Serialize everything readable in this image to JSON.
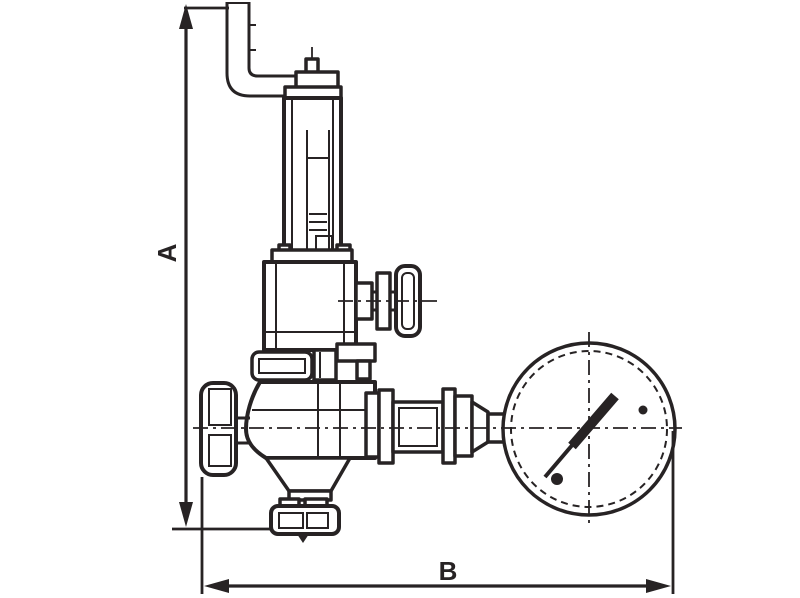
{
  "colors": {
    "ink": "#272324",
    "background": "#ffffff"
  },
  "dimensions": {
    "vertical": {
      "label": "A"
    },
    "horizontal": {
      "label": "B"
    }
  },
  "drawing": {
    "kind": "technical-line-drawing",
    "components": [
      "discharge-elbow-pipe",
      "spring-housing",
      "adjusting-screw",
      "bonnet",
      "test-tap-handle",
      "valve-body",
      "handwheel",
      "bottom-outlet-flange",
      "gauge-coupling",
      "pressure-gauge",
      "gauge-needle"
    ]
  }
}
